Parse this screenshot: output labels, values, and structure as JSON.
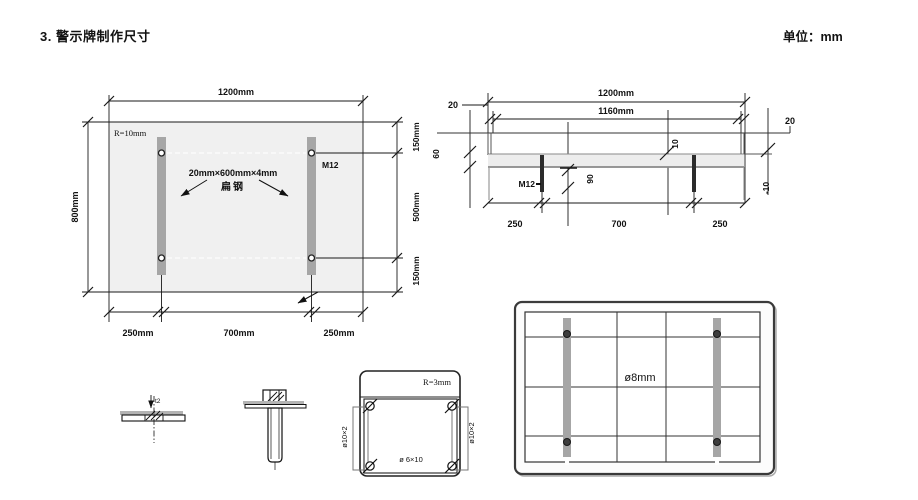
{
  "page": {
    "title": "3. 警示牌制作尺寸",
    "unit": "单位：mm"
  },
  "front_view": {
    "dim_width": "1200mm",
    "dim_height": "800mm",
    "corner_radius": "R=10mm",
    "steel_spec": "20mm×600mm×4mm",
    "steel_name": "扁钢",
    "bolt": "M12",
    "dim_right": [
      "150mm",
      "500mm",
      "150mm"
    ],
    "dim_bottom": [
      "250mm",
      "700mm",
      "250mm"
    ]
  },
  "section_view": {
    "dim_width": "1200mm",
    "dim_inner_width": "1160mm",
    "dim_edge_left": "20",
    "dim_edge_right": "20",
    "dim_depth": "60",
    "dim_offset_top": "10",
    "dim_offset_right": "-10",
    "bolt": "M12",
    "dim_bolt": "90",
    "dim_bottom": [
      "250",
      "700",
      "250"
    ]
  },
  "back_view": {
    "hole": "ø8mm"
  },
  "details": {
    "plate_thickness": "t2",
    "bracket_radius": "R=3mm",
    "slot_left": "ø10×2",
    "slot_right": "ø10×2",
    "bracket_hole": "ø 6×10"
  },
  "colors": {
    "line": "#1a1a1a",
    "panel_fill": "#f0f0f0",
    "bar_fill": "#a6a6a6",
    "band_fill": "#ededed"
  }
}
